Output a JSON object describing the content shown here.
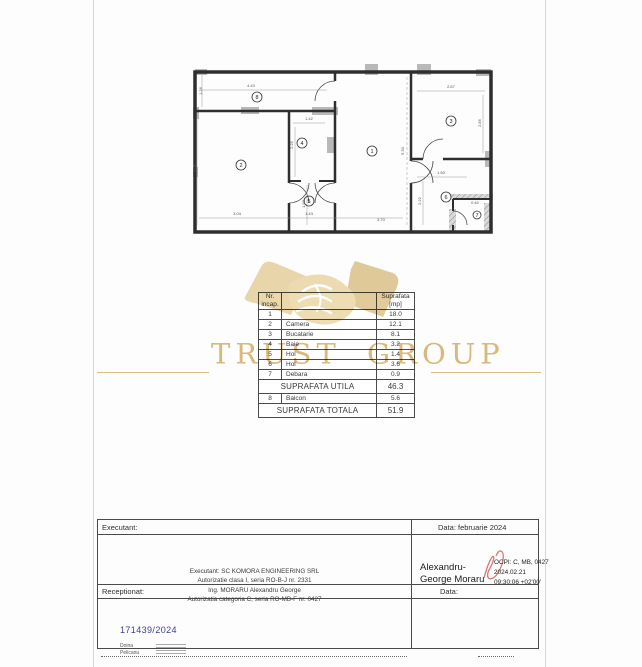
{
  "watermark": {
    "text": "TRUST GROUP"
  },
  "floor_plan": {
    "rooms": [
      {
        "n": "1",
        "x": 183,
        "y": 88
      },
      {
        "n": "2",
        "x": 52,
        "y": 102
      },
      {
        "n": "3",
        "x": 262,
        "y": 58
      },
      {
        "n": "4",
        "x": 113,
        "y": 80
      },
      {
        "n": "5",
        "x": 120,
        "y": 138
      },
      {
        "n": "6",
        "x": 257,
        "y": 134
      },
      {
        "n": "7",
        "x": 288,
        "y": 152
      },
      {
        "n": "8",
        "x": 68,
        "y": 34
      }
    ],
    "dims": [
      {
        "t": "4.43",
        "x": 62,
        "y": 24,
        "v": false
      },
      {
        "t": "1.26",
        "x": 13,
        "y": 28,
        "v": true
      },
      {
        "t": "2.67",
        "x": 262,
        "y": 25,
        "v": false
      },
      {
        "t": "2.85",
        "x": 292,
        "y": 60,
        "v": true
      },
      {
        "t": "1.42",
        "x": 120,
        "y": 57,
        "v": false
      },
      {
        "t": "2.25",
        "x": 104,
        "y": 82,
        "v": true
      },
      {
        "t": "5.30",
        "x": 215,
        "y": 88,
        "v": true
      },
      {
        "t": "4.05",
        "x": 7,
        "y": 105,
        "v": true
      },
      {
        "t": "1.50",
        "x": 252,
        "y": 111,
        "v": false
      },
      {
        "t": "2.22",
        "x": 232,
        "y": 138,
        "v": true
      },
      {
        "t": "0.40",
        "x": 286,
        "y": 141,
        "v": false
      },
      {
        "t": "1.50",
        "x": 116,
        "y": 141,
        "v": true
      },
      {
        "t": "3.04",
        "x": 48,
        "y": 152,
        "v": false
      },
      {
        "t": "1.43",
        "x": 120,
        "y": 152,
        "v": false
      },
      {
        "t": "3.70",
        "x": 192,
        "y": 158,
        "v": false
      }
    ]
  },
  "table": {
    "header_col1": "Nr. incap.",
    "header_col2": "",
    "header_col3": "Suprafata [mp]",
    "rows": [
      [
        "1",
        "",
        "18.0"
      ],
      [
        "2",
        "Camera",
        "12.1"
      ],
      [
        "3",
        "Bucatarie",
        "8.1"
      ],
      [
        "4",
        "Baie",
        "3.2"
      ],
      [
        "5",
        "Hol",
        "1.4"
      ],
      [
        "6",
        "Hol",
        "3.6"
      ],
      [
        "7",
        "Debara",
        "0.9"
      ]
    ],
    "utila_label": "SUPRAFATA UTILA",
    "utila_value": "46.3",
    "balcon_row": [
      "8",
      "Balcon",
      "5.6"
    ],
    "totala_label": "SUPRAFATA TOTALA",
    "totala_value": "51.9"
  },
  "footer": {
    "executant_header": "Executant:",
    "executant_lines": [
      "Executant: SC KOMORA ENGINEERING SRL",
      "Autorizatie clasa I, seria RO-B-J nr. 2331",
      "Ing. MORARU Alexandru George",
      "Autorizatia categoria C, seria RO-MB-F nr. 0427"
    ],
    "data_header": "Data: februarie 2024",
    "signer_name_1": "Alexandru-",
    "signer_name_2": "George Moraru",
    "ocpi_lines": [
      "OCPI: C, MB, 0427",
      "2024.02.21",
      "09:30:06 +02'00'"
    ],
    "receptionat_header": "Receptionat:",
    "registration_number": "171439/2024",
    "stamp_name_1": "Doina",
    "stamp_name_2": "Pelicanu",
    "data_header_2": "Data:"
  }
}
